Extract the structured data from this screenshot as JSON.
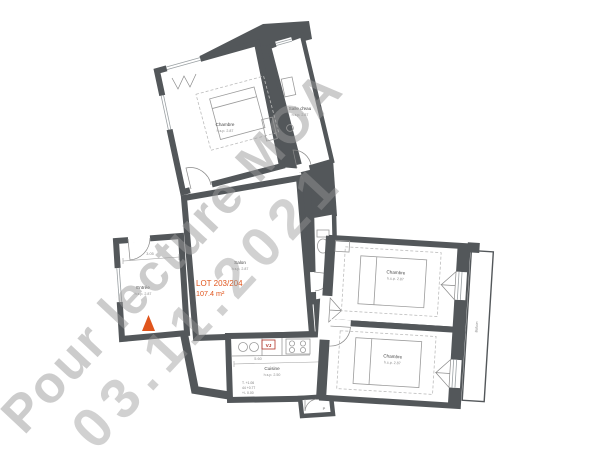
{
  "watermark": {
    "line1": "Pour lecture MOA",
    "line2": "03.11.2021"
  },
  "lot": {
    "code": "LOT 203/204",
    "area": "107.4 m²"
  },
  "rooms": {
    "chambre_tl": {
      "name": "Chambre",
      "hsp": "h.s.p. 2.87"
    },
    "salle_eau": {
      "name": "Salle d'eau",
      "hsp": "h.s.p. 2.87"
    },
    "salon": {
      "name": "Salon",
      "hsp": "h.s.p. 2.87"
    },
    "entree": {
      "name": "Entrée",
      "hsp": "h.s.p. 2.87"
    },
    "cuisine": {
      "name": "Cuisine",
      "hsp": "h.s.p. 2.50"
    },
    "chambre_r1": {
      "name": "Chambre",
      "hsp": "h.s.p. 2.87"
    },
    "chambre_r2": {
      "name": "Chambre",
      "hsp": "h.s.p. 2.87"
    },
    "balcon": {
      "name": "Balcon"
    }
  },
  "annotations": {
    "vj": "VJ",
    "door_label": "P",
    "levels": [
      "T. +1.06",
      "44 +0.77",
      "+/- 0.00"
    ],
    "dims": {
      "entree": "3.05",
      "cuisine": "5.60"
    }
  },
  "colors": {
    "wall": "#53575a",
    "accent_orange": "#e0551c",
    "watermark_gray": "#9a9a9a",
    "vj_red": "#b23327"
  }
}
